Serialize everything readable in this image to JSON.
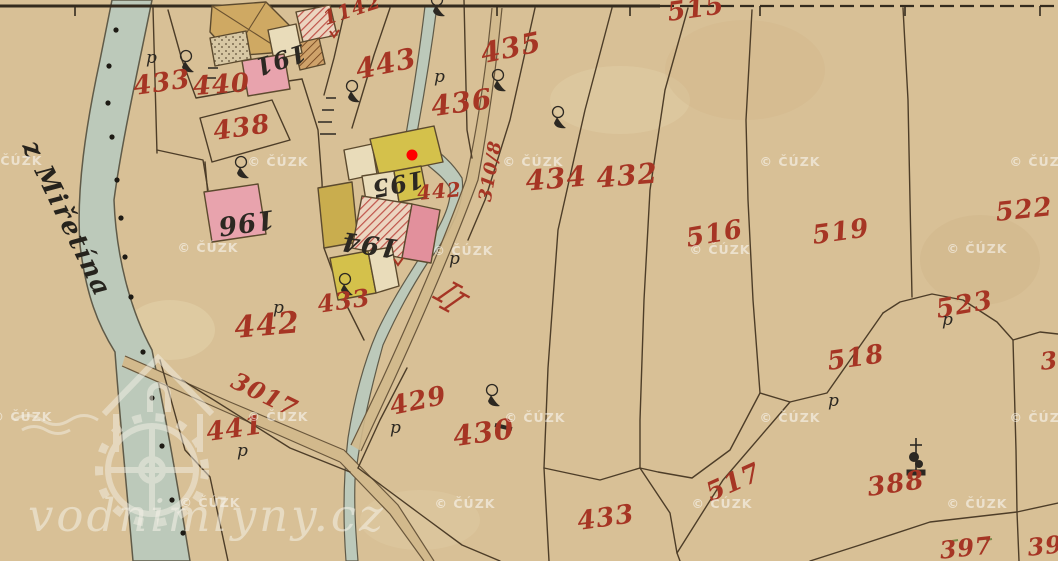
{
  "map": {
    "script_label": "z Miřetína",
    "p_glyph": "p",
    "labels": [
      {
        "text": "433",
        "x": 163,
        "y": 91,
        "rot": -8,
        "size": 26,
        "ink": "red"
      },
      {
        "text": "440",
        "x": 222,
        "y": 93,
        "rot": -4,
        "size": 26,
        "ink": "red"
      },
      {
        "text": "438",
        "x": 243,
        "y": 136,
        "rot": -8,
        "size": 26,
        "ink": "red"
      },
      {
        "text": "1142",
        "x": 354,
        "y": 16,
        "rot": -18,
        "size": 20,
        "ink": "red"
      },
      {
        "text": "443",
        "x": 388,
        "y": 73,
        "rot": -12,
        "size": 28,
        "ink": "red"
      },
      {
        "text": "435",
        "x": 513,
        "y": 57,
        "rot": -12,
        "size": 28,
        "ink": "red"
      },
      {
        "text": "436",
        "x": 463,
        "y": 112,
        "rot": -8,
        "size": 28,
        "ink": "red"
      },
      {
        "text": "515",
        "x": 697,
        "y": 17,
        "rot": -8,
        "size": 26,
        "ink": "red"
      },
      {
        "text": "434",
        "x": 557,
        "y": 188,
        "rot": -5,
        "size": 28,
        "ink": "red"
      },
      {
        "text": "432",
        "x": 628,
        "y": 185,
        "rot": -5,
        "size": 28,
        "ink": "red"
      },
      {
        "text": "310/8",
        "x": 496,
        "y": 172,
        "rot": -80,
        "size": 18,
        "ink": "red"
      },
      {
        "text": "516",
        "x": 716,
        "y": 242,
        "rot": -10,
        "size": 26,
        "ink": "red"
      },
      {
        "text": "519",
        "x": 842,
        "y": 240,
        "rot": -8,
        "size": 26,
        "ink": "red"
      },
      {
        "text": "522",
        "x": 1025,
        "y": 218,
        "rot": -6,
        "size": 26,
        "ink": "red"
      },
      {
        "text": "523",
        "x": 966,
        "y": 313,
        "rot": -10,
        "size": 26,
        "ink": "red"
      },
      {
        "text": "518",
        "x": 857,
        "y": 366,
        "rot": -8,
        "size": 26,
        "ink": "red"
      },
      {
        "text": "517",
        "x": 737,
        "y": 490,
        "rot": -24,
        "size": 26,
        "ink": "red"
      },
      {
        "text": "388",
        "x": 897,
        "y": 492,
        "rot": -8,
        "size": 26,
        "ink": "red"
      },
      {
        "text": "442",
        "x": 268,
        "y": 335,
        "rot": -5,
        "size": 30,
        "ink": "red"
      },
      {
        "text": "442",
        "x": 440,
        "y": 198,
        "rot": -5,
        "size": 20,
        "ink": "red"
      },
      {
        "text": "433",
        "x": 345,
        "y": 309,
        "rot": -8,
        "size": 24,
        "ink": "red"
      },
      {
        "text": "433",
        "x": 607,
        "y": 526,
        "rot": -8,
        "size": 26,
        "ink": "red"
      },
      {
        "text": "430",
        "x": 485,
        "y": 442,
        "rot": -8,
        "size": 28,
        "ink": "red"
      },
      {
        "text": "429",
        "x": 420,
        "y": 409,
        "rot": -12,
        "size": 26,
        "ink": "red"
      },
      {
        "text": "441",
        "x": 236,
        "y": 437,
        "rot": -8,
        "size": 26,
        "ink": "red"
      },
      {
        "text": "3017",
        "x": 261,
        "y": 402,
        "rot": 26,
        "size": 24,
        "ink": "red"
      },
      {
        "text": "397",
        "x": 967,
        "y": 556,
        "rot": -6,
        "size": 24,
        "ink": "red"
      },
      {
        "text": "39",
        "x": 1046,
        "y": 554,
        "rot": -6,
        "size": 24,
        "ink": "red"
      },
      {
        "text": "3",
        "x": 1050,
        "y": 369,
        "rot": -6,
        "size": 24,
        "ink": "red"
      },
      {
        "text": "191",
        "x": 278,
        "y": 52,
        "rot": 162,
        "size": 24,
        "ink": "black"
      },
      {
        "text": "196",
        "x": 245,
        "y": 214,
        "rot": 172,
        "size": 26,
        "ink": "black"
      },
      {
        "text": "195",
        "x": 396,
        "y": 176,
        "rot": 168,
        "size": 24,
        "ink": "black"
      },
      {
        "text": "194",
        "x": 371,
        "y": 236,
        "rot": 188,
        "size": 26,
        "ink": "black"
      }
    ],
    "p_marks": [
      [
        146,
        63
      ],
      [
        434,
        82
      ],
      [
        273,
        313
      ],
      [
        390,
        433
      ],
      [
        828,
        406
      ],
      [
        942,
        325
      ],
      [
        237,
        456
      ],
      [
        449,
        264
      ]
    ],
    "trees": [
      [
        186,
        64
      ],
      [
        241,
        170
      ],
      [
        352,
        94
      ],
      [
        437,
        8
      ],
      [
        498,
        83
      ],
      [
        558,
        120
      ],
      [
        492,
        398
      ],
      [
        345,
        287
      ]
    ],
    "river_dots": [
      [
        116,
        30
      ],
      [
        109,
        66
      ],
      [
        108,
        103
      ],
      [
        112,
        137
      ],
      [
        117,
        180
      ],
      [
        121,
        218
      ],
      [
        125,
        257
      ],
      [
        131,
        297
      ],
      [
        143,
        352
      ],
      [
        152,
        398
      ],
      [
        162,
        446
      ],
      [
        172,
        500
      ],
      [
        183,
        533
      ]
    ],
    "marker": {
      "x": 412,
      "y": 155,
      "color": "#ff0000"
    }
  },
  "watermarks": {
    "text": "© ČÚZK",
    "site": "vodnimlyny.cz",
    "positions": [
      [
        12,
        165
      ],
      [
        278,
        166
      ],
      [
        533,
        166
      ],
      [
        790,
        166
      ],
      [
        1040,
        166
      ],
      [
        208,
        252
      ],
      [
        463,
        255
      ],
      [
        720,
        254
      ],
      [
        977,
        253
      ],
      [
        22,
        421
      ],
      [
        278,
        421
      ],
      [
        535,
        422
      ],
      [
        790,
        422
      ],
      [
        1040,
        422
      ],
      [
        210,
        507
      ],
      [
        465,
        508
      ],
      [
        722,
        508
      ],
      [
        977,
        508
      ]
    ]
  },
  "colors": {
    "paper": "#d8c096",
    "river": "#bcc9ba",
    "road": "#d2b98c",
    "boundary_ink": "#4d3d28",
    "parcel_red": "#a63524",
    "house_black": "#2c2822",
    "building_yellow": "#d4c14b",
    "building_pink": "#e8a3ad",
    "building_hatch": "#c0544a",
    "watermark": "rgba(255,255,255,0.52)",
    "marker_red": "#ff0000"
  }
}
